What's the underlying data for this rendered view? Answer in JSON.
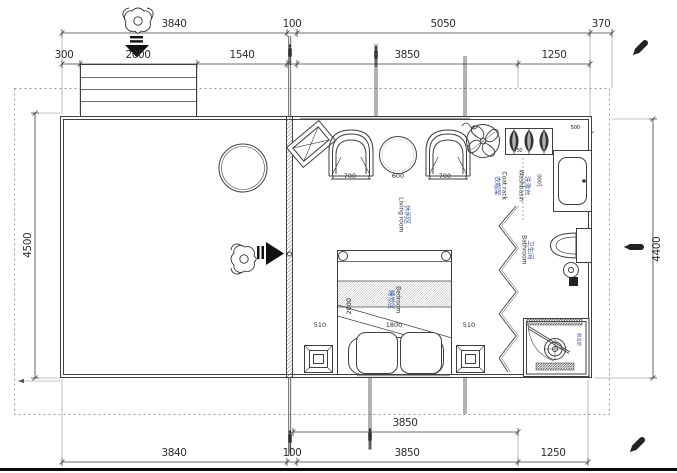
{
  "dimensions": {
    "top_outer": [
      "3840",
      "100",
      "5050",
      "370"
    ],
    "top_inner": [
      "300",
      "2000",
      "1540",
      "3850",
      "1250"
    ],
    "bottom_inner": [
      "3850"
    ],
    "bottom_outer": [
      "3840",
      "100",
      "3850",
      "1250"
    ],
    "left_height": "4500",
    "right_height": "4400",
    "seating": [
      "700",
      "600",
      "700"
    ],
    "coat_rack_width": "750",
    "washbasin_width": "500",
    "washbasin_length": "1000",
    "bed_side_left": "510",
    "bed_width": "1800",
    "bed_side_right": "510",
    "bed_length": "2000"
  },
  "rooms": {
    "living": {
      "zh": "休闲区",
      "en": "Living room"
    },
    "bedroom": {
      "zh": "睡觉区",
      "en": "Bedroom"
    },
    "bathroom": {
      "zh": "卫生间",
      "en": "Bathroom"
    },
    "washbasin": {
      "zh": "洗漱台",
      "en": "Washbasin"
    },
    "coat_rack": {
      "zh": "衣帽架",
      "en": "Coat rack"
    },
    "shower": {
      "zh": "淋浴房"
    }
  },
  "colors": {
    "line": "#3f3f3f",
    "label_zh": "#4059a8",
    "dash": "#999999"
  },
  "icons": [
    "person-icon",
    "down-arrow-icon",
    "right-arrow-icon",
    "ceiling-fan-icon",
    "pen-icon",
    "survey-pin-icon"
  ]
}
